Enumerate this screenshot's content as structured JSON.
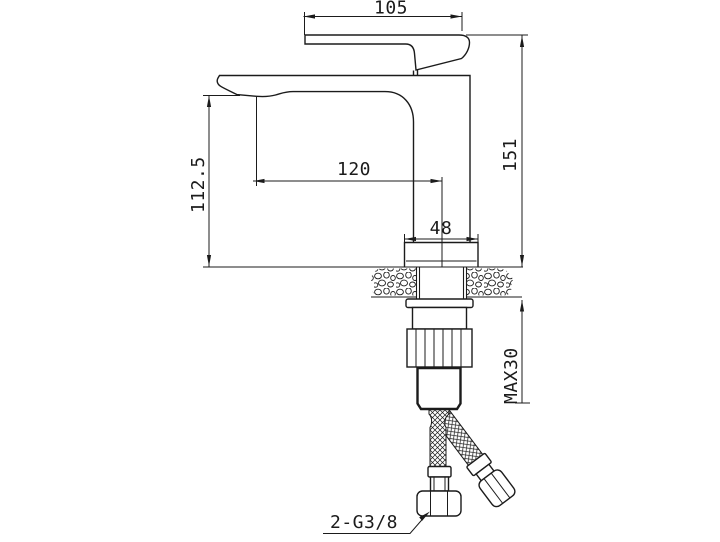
{
  "drawing": {
    "background": "#ffffff",
    "line_color": "#1b1b1b"
  },
  "dimensions": {
    "handle_length": "105",
    "overall_height": "151",
    "spout_height": "112.5",
    "spout_reach": "120",
    "base_width": "48",
    "max_mounting_thickness": "MAX30",
    "hose_connection": "2-G3/8"
  }
}
